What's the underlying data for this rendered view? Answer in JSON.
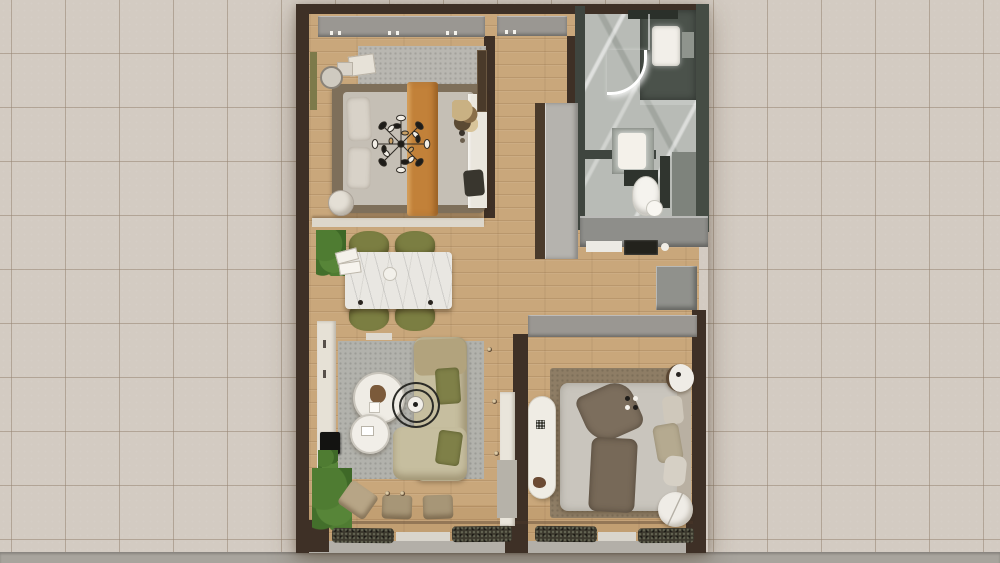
{
  "meta": {
    "description": "Top-down 3D rendered floor plan of a small apartment placed on a beige ceramic-tile background",
    "view": "top-down orthographic render",
    "visible_text": "none"
  },
  "background": {
    "tile_color": "#d3cbc2",
    "grout_color": "#b1a496",
    "tile_size_px": 54,
    "bottom_concrete_color": "#a8a49d"
  },
  "palette": {
    "outer_wall_brown": "#3e3026",
    "bathroom_wall_green_gray": "#454c44",
    "wood_floor": "#c9a77b",
    "bathroom_marble": "#b8bbb6",
    "cabinet_gray": "#9a9792",
    "counter_dark": "#4b524b",
    "accent_orange": "#c28139",
    "chair_olive": "#7b7e42",
    "sofa_beige": "#c6be9f",
    "rug_gray": "#b2b2ac",
    "rug_brown": "#8e7d65",
    "plant_green": "#4f7c32",
    "furniture_white": "#efece5"
  },
  "rooms": [
    {
      "id": "bedroom-1",
      "position": "top-left",
      "furniture": [
        "built-in-wardrobe",
        "double-bed-brown-frame",
        "gray-bedding",
        "orange-throw-runner",
        "sputnik-chandelier",
        "gray-area-rug",
        "bedside-tables",
        "reading-chair",
        "round-stool",
        "white-desk",
        "desk-chair",
        "dried-plant",
        "dark-wardrobe-column"
      ]
    },
    {
      "id": "bathroom",
      "position": "top-right",
      "furniture": [
        "marble-floor",
        "dark-vanity-counter",
        "white-sink",
        "led-mirror-light",
        "shower-area",
        "washbasin-unit",
        "dark-storage-shelf",
        "toilet",
        "round-lid"
      ]
    },
    {
      "id": "entry-hall",
      "position": "top-center",
      "furniture": [
        "entry-wardrobe",
        "tall-gray-cabinet"
      ]
    },
    {
      "id": "kitchenette",
      "position": "mid-right",
      "furniture": [
        "gray-counter",
        "cooktop",
        "counter-sink",
        "storage-box"
      ]
    },
    {
      "id": "dining-area",
      "position": "mid-left",
      "furniture": [
        "marble-dining-table",
        "olive-dining-chairs-x4",
        "potted-plant",
        "white-books",
        "round-plate"
      ]
    },
    {
      "id": "living-room",
      "position": "bottom-left",
      "furniture": [
        "tv-console",
        "tv",
        "gray-area-rug",
        "l-shaped-beige-sofa",
        "olive-cushions",
        "round-coffee-table-large",
        "round-coffee-table-small",
        "arc-floor-lamp",
        "tan-ottomans-x3",
        "floor-plants",
        "recessed-floor-lights"
      ]
    },
    {
      "id": "bedroom-2",
      "position": "bottom-right",
      "furniture": [
        "gray-wardrobe-strip",
        "brown-area-rug",
        "double-bed",
        "brown-throw",
        "beige-pillows",
        "round-nightstand-top",
        "round-nightstand-bottom",
        "white-pill-bench",
        "white-closet"
      ]
    },
    {
      "id": "balcony",
      "position": "bottom-strip",
      "furniture": [
        "hedge-planters-x4",
        "window-sills",
        "railing-posts"
      ]
    }
  ]
}
